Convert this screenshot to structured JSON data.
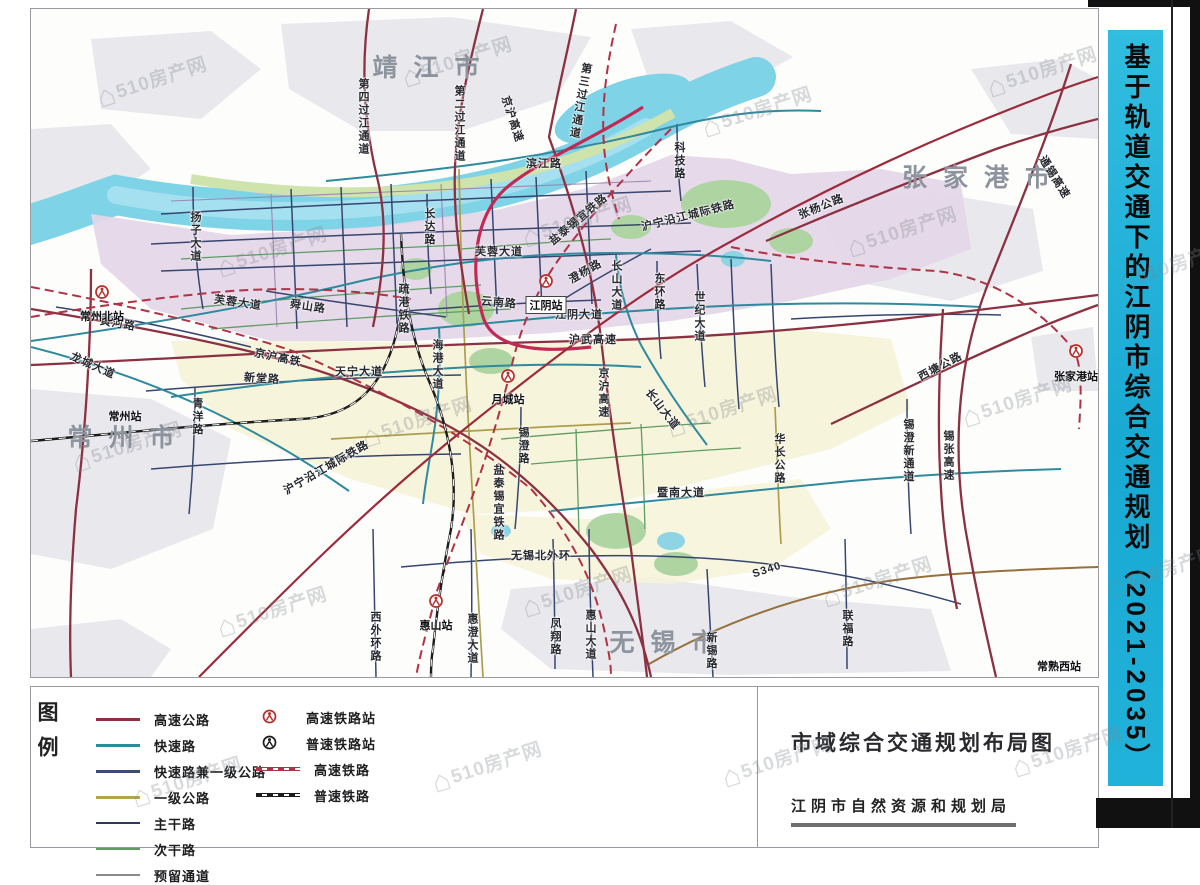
{
  "banner": {
    "title": "基于轨道交通下的江阴市综合交通规划（2021-2035）",
    "bg_color": "#1fadd6"
  },
  "watermark": {
    "text": "510房产网"
  },
  "legend": {
    "title": "图例",
    "road_items": [
      {
        "label": "高速公路",
        "color": "#8c3142",
        "width": 3
      },
      {
        "label": "快速路",
        "color": "#2f8a9e",
        "width": 3
      },
      {
        "label": "快速路兼一级公路",
        "color": "#3c4d75",
        "width": 3
      },
      {
        "label": "一级公路",
        "color": "#b3a44e",
        "width": 3
      },
      {
        "label": "主干路",
        "color": "#2b3a5e",
        "width": 2
      },
      {
        "label": "次干路",
        "color": "#5f9c63",
        "width": 2
      },
      {
        "label": "预留通道",
        "color": "#8a8a8a",
        "width": 2,
        "clipped": true
      }
    ],
    "rail_items": [
      {
        "label": "高速铁路站",
        "type": "station",
        "color": "#b5302c"
      },
      {
        "label": "普速铁路站",
        "type": "station",
        "color": "#1c1c1c"
      },
      {
        "label": "高速铁路",
        "type": "line",
        "color": "#b03245"
      },
      {
        "label": "普速铁路",
        "type": "line",
        "color": "#1c1c1c"
      }
    ]
  },
  "info_panel": {
    "map_title": "市域综合交通规划布局图",
    "agency": "江阴市自然资源和规划局"
  },
  "map": {
    "cities": [
      {
        "name": "靖江市",
        "x": 395,
        "y": 57
      },
      {
        "name": "张家港市",
        "x": 945,
        "y": 167
      },
      {
        "name": "常州市",
        "x": 90,
        "y": 427
      },
      {
        "name": "无锡市",
        "x": 632,
        "y": 632
      }
    ],
    "stations": [
      {
        "name": "常州北站",
        "x": 71,
        "y": 283,
        "type": "hsr",
        "ly": 16
      },
      {
        "name": "江阴站",
        "x": 515,
        "y": 272,
        "type": "hsr",
        "ly": 15,
        "boxed": true
      },
      {
        "name": "月城站",
        "x": 477,
        "y": 367,
        "type": "hsr",
        "ly": 15
      },
      {
        "name": "惠山站",
        "x": 405,
        "y": 592,
        "type": "hsr",
        "ly": 16
      },
      {
        "name": "张家港站",
        "x": 1045,
        "y": 342,
        "type": "hsr",
        "ly": 17
      },
      {
        "name": "常州站",
        "x": 94,
        "y": 405,
        "type": "label-only"
      },
      {
        "name": "常熟西站",
        "x": 1028,
        "y": 655,
        "type": "label-only"
      }
    ],
    "road_labels": [
      {
        "text": "第四过江通道",
        "x": 332,
        "y": 108,
        "v": true
      },
      {
        "text": "第二过江通道",
        "x": 428,
        "y": 115,
        "v": true
      },
      {
        "text": "京沪高速",
        "x": 482,
        "y": 110,
        "rot": 72
      },
      {
        "text": "第三过江通道",
        "x": 549,
        "y": 92,
        "v": true,
        "rot": 10
      },
      {
        "text": "滨江路",
        "x": 513,
        "y": 154
      },
      {
        "text": "科技路",
        "x": 648,
        "y": 152,
        "v": true
      },
      {
        "text": "长达路",
        "x": 398,
        "y": 218,
        "v": true
      },
      {
        "text": "扬子大道",
        "x": 164,
        "y": 228,
        "v": true
      },
      {
        "text": "芙蓉大道",
        "x": 207,
        "y": 293,
        "rot": 8
      },
      {
        "text": "芙蓉大道",
        "x": 468,
        "y": 242
      },
      {
        "text": "舜山路",
        "x": 277,
        "y": 297,
        "rot": 8
      },
      {
        "text": "黄河路",
        "x": 87,
        "y": 314,
        "rot": 10
      },
      {
        "text": "龙城大道",
        "x": 62,
        "y": 356,
        "rot": 24
      },
      {
        "text": "京沪高铁",
        "x": 247,
        "y": 348,
        "rot": 12
      },
      {
        "text": "新堂路",
        "x": 231,
        "y": 369,
        "rot": 4
      },
      {
        "text": "天宁大道",
        "x": 328,
        "y": 362
      },
      {
        "text": "青洋路",
        "x": 166,
        "y": 408,
        "v": true
      },
      {
        "text": "沪宁沿江城际铁路",
        "x": 657,
        "y": 206,
        "rot": -14
      },
      {
        "text": "沪宁沿江城际铁路",
        "x": 295,
        "y": 458,
        "rot": -30
      },
      {
        "text": "疏港铁路",
        "x": 372,
        "y": 300,
        "v": true
      },
      {
        "text": "海港大道",
        "x": 406,
        "y": 356,
        "v": true
      },
      {
        "text": "云南路",
        "x": 468,
        "y": 293,
        "rot": 5
      },
      {
        "text": "江阴大道",
        "x": 548,
        "y": 305
      },
      {
        "text": "沪武高速",
        "x": 562,
        "y": 330
      },
      {
        "text": "澄杨路",
        "x": 554,
        "y": 262,
        "rot": -30
      },
      {
        "text": "盐泰锡宜铁路",
        "x": 547,
        "y": 210,
        "rot": -40
      },
      {
        "text": "长山大道",
        "x": 585,
        "y": 277,
        "v": true
      },
      {
        "text": "东环路",
        "x": 628,
        "y": 283,
        "v": true
      },
      {
        "text": "世纪大道",
        "x": 668,
        "y": 308,
        "v": true
      },
      {
        "text": "京沪高速",
        "x": 572,
        "y": 384,
        "v": true
      },
      {
        "text": "长山大道",
        "x": 632,
        "y": 400,
        "rot": 52
      },
      {
        "text": "锡澄路",
        "x": 492,
        "y": 437,
        "v": true
      },
      {
        "text": "盐泰锡宜铁路",
        "x": 467,
        "y": 494,
        "v": true
      },
      {
        "text": "暨南大道",
        "x": 650,
        "y": 483
      },
      {
        "text": "华长公路",
        "x": 748,
        "y": 450,
        "v": true
      },
      {
        "text": "张杨公路",
        "x": 790,
        "y": 197,
        "rot": -22
      },
      {
        "text": "通锡高速",
        "x": 1024,
        "y": 168,
        "rot": 58
      },
      {
        "text": "西塘公路",
        "x": 909,
        "y": 357,
        "rot": -28
      },
      {
        "text": "锡澄新通道",
        "x": 877,
        "y": 442,
        "v": true
      },
      {
        "text": "锡张高速",
        "x": 917,
        "y": 447,
        "v": true
      },
      {
        "text": "无锡北外环",
        "x": 510,
        "y": 546
      },
      {
        "text": "西外环路",
        "x": 344,
        "y": 628,
        "v": true
      },
      {
        "text": "惠澄大道",
        "x": 441,
        "y": 630,
        "v": true
      },
      {
        "text": "凤翔路",
        "x": 524,
        "y": 628,
        "v": true
      },
      {
        "text": "惠山大道",
        "x": 559,
        "y": 626,
        "v": true
      },
      {
        "text": "新锡路",
        "x": 680,
        "y": 642,
        "v": true
      },
      {
        "text": "S340",
        "x": 736,
        "y": 561,
        "rot": -18
      },
      {
        "text": "联福路",
        "x": 816,
        "y": 620,
        "v": true
      }
    ]
  }
}
